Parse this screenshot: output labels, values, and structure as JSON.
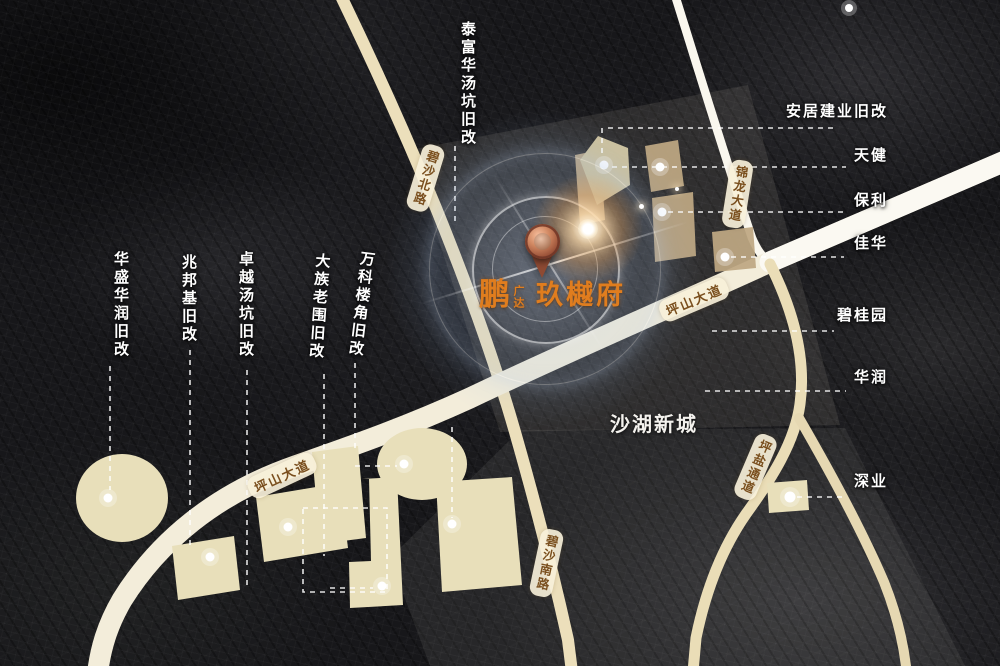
{
  "map": {
    "project": {
      "logo_main": "鹏",
      "logo_sub": "广达",
      "name": "玖樾府"
    },
    "area_label": "沙湖新城",
    "top_label": "泰富华汤坑旧改",
    "left_labels": [
      "华盛华润旧改",
      "兆邦基旧改",
      "卓越汤坑旧改",
      "大族老围旧改",
      "万科楼角旧改"
    ],
    "right_labels": [
      "安居建业旧改",
      "天健",
      "保利",
      "佳华",
      "碧桂园",
      "华润",
      "深业"
    ],
    "road_labels": [
      "碧沙北路",
      "锦龙大道",
      "坪山大道",
      "坪山大道",
      "坪盐通道",
      "碧沙南路"
    ],
    "colors": {
      "accent_orange": "#e07d1e",
      "road_beige": "#ecdfbb",
      "road_white": "#faf7ee",
      "parcel_light": "#e8dfba",
      "parcel_tan": "#bfa883",
      "road_text_brown": "#7a4f1e",
      "label_white": "#ffffff"
    }
  }
}
